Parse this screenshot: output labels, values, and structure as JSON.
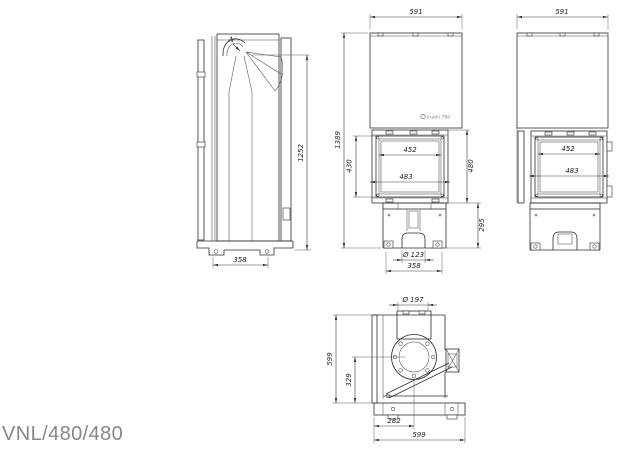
{
  "title": "VNL/480/480",
  "detail_label": "A",
  "logo_stamp": "kratki 790",
  "side_view": {
    "height": "1252",
    "depth": "358"
  },
  "front_view": {
    "width": "591",
    "total_height": "1389",
    "glass_height": "430",
    "glass_width": "452",
    "opening_width": "483",
    "firebox_height": "480",
    "base_height": "295",
    "inlet_diameter": "Ø 123",
    "base_width": "358"
  },
  "right_view": {
    "width": "591",
    "glass_width": "452",
    "opening_width": "483"
  },
  "top_view": {
    "flue_diameter": "Ø 197",
    "depth": "599",
    "flue_center_from_front": "329",
    "flue_center_from_left": "282",
    "width": "599"
  }
}
